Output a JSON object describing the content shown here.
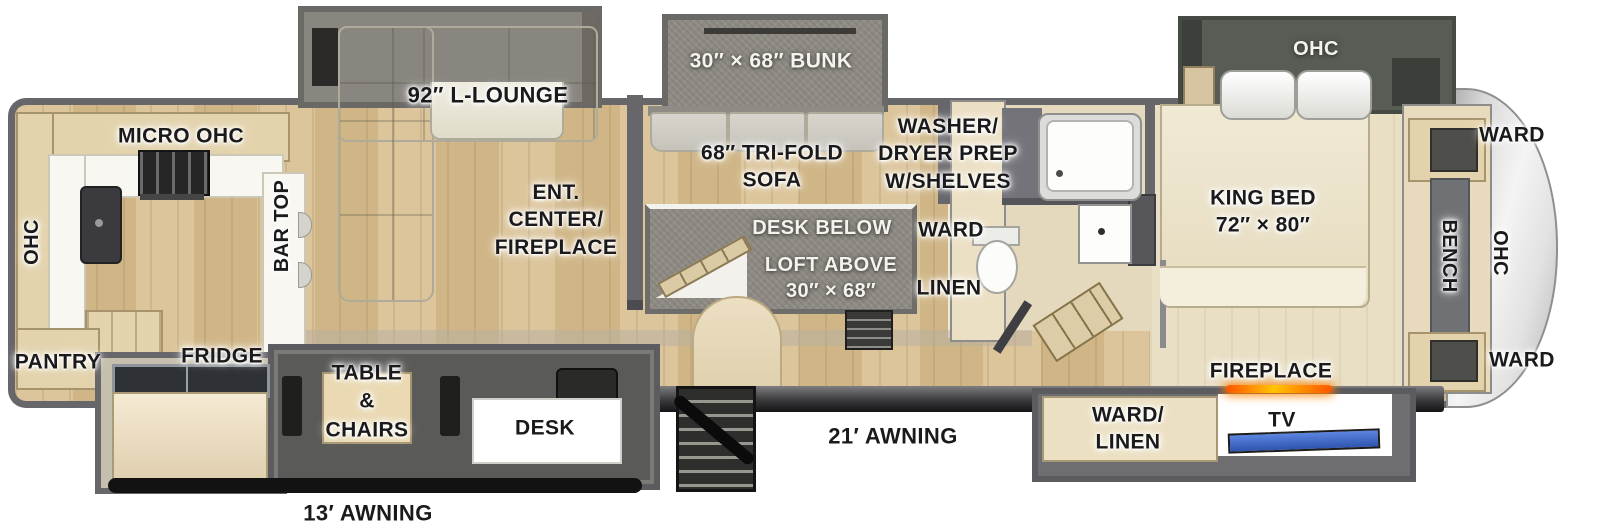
{
  "title": "Fifth wheel RV floorplan",
  "colors": {
    "wall_gray": "#67666b",
    "floor_wood": "#d7bf94",
    "floor_bedroom": "#e9dfc6",
    "slide_gray": "#8d8983",
    "fireplace_glow": "#ff7a00",
    "tv_screen": "#3f6fd8",
    "label_black": "#1a1a1c",
    "label_white": "#f4f3ee"
  },
  "slides": {
    "lounge_label": "92″ L-LOUNGE",
    "bunk_label": "30″ × 68″ BUNK",
    "bedroom_ohc_label": "OHC"
  },
  "kitchen": {
    "micro_ohc": "MICRO  OHC",
    "rear_ohc": "OHC",
    "bar_top": "BAR TOP",
    "pantry": "PANTRY",
    "fridge": "FRIDGE"
  },
  "living": {
    "ent_center": "ENT.\nCENTER/\nFIREPLACE",
    "tri_fold_sofa": "68″ TRI-FOLD\nSOFA"
  },
  "loft": {
    "desk_below": "DESK BELOW",
    "loft_above": "LOFT ABOVE\n30″ × 68″"
  },
  "bath": {
    "washer_dryer": "WASHER/\nDRYER PREP\nW/SHELVES",
    "ward": "WARD",
    "linen": "LINEN"
  },
  "bedroom": {
    "king_bed": "KING BED\n72″ × 80″",
    "fireplace": "FIREPLACE"
  },
  "front": {
    "ward_top": "WARD",
    "ward_bottom": "WARD",
    "bench": "BENCH",
    "ohc": "OHC"
  },
  "lower": {
    "table_chairs": "TABLE\n&\nCHAIRS",
    "desk": "DESK",
    "ward_linen": "WARD/\nLINEN",
    "tv": "TV",
    "awning_21": "21′ AWNING",
    "awning_13": "13′ AWNING"
  }
}
